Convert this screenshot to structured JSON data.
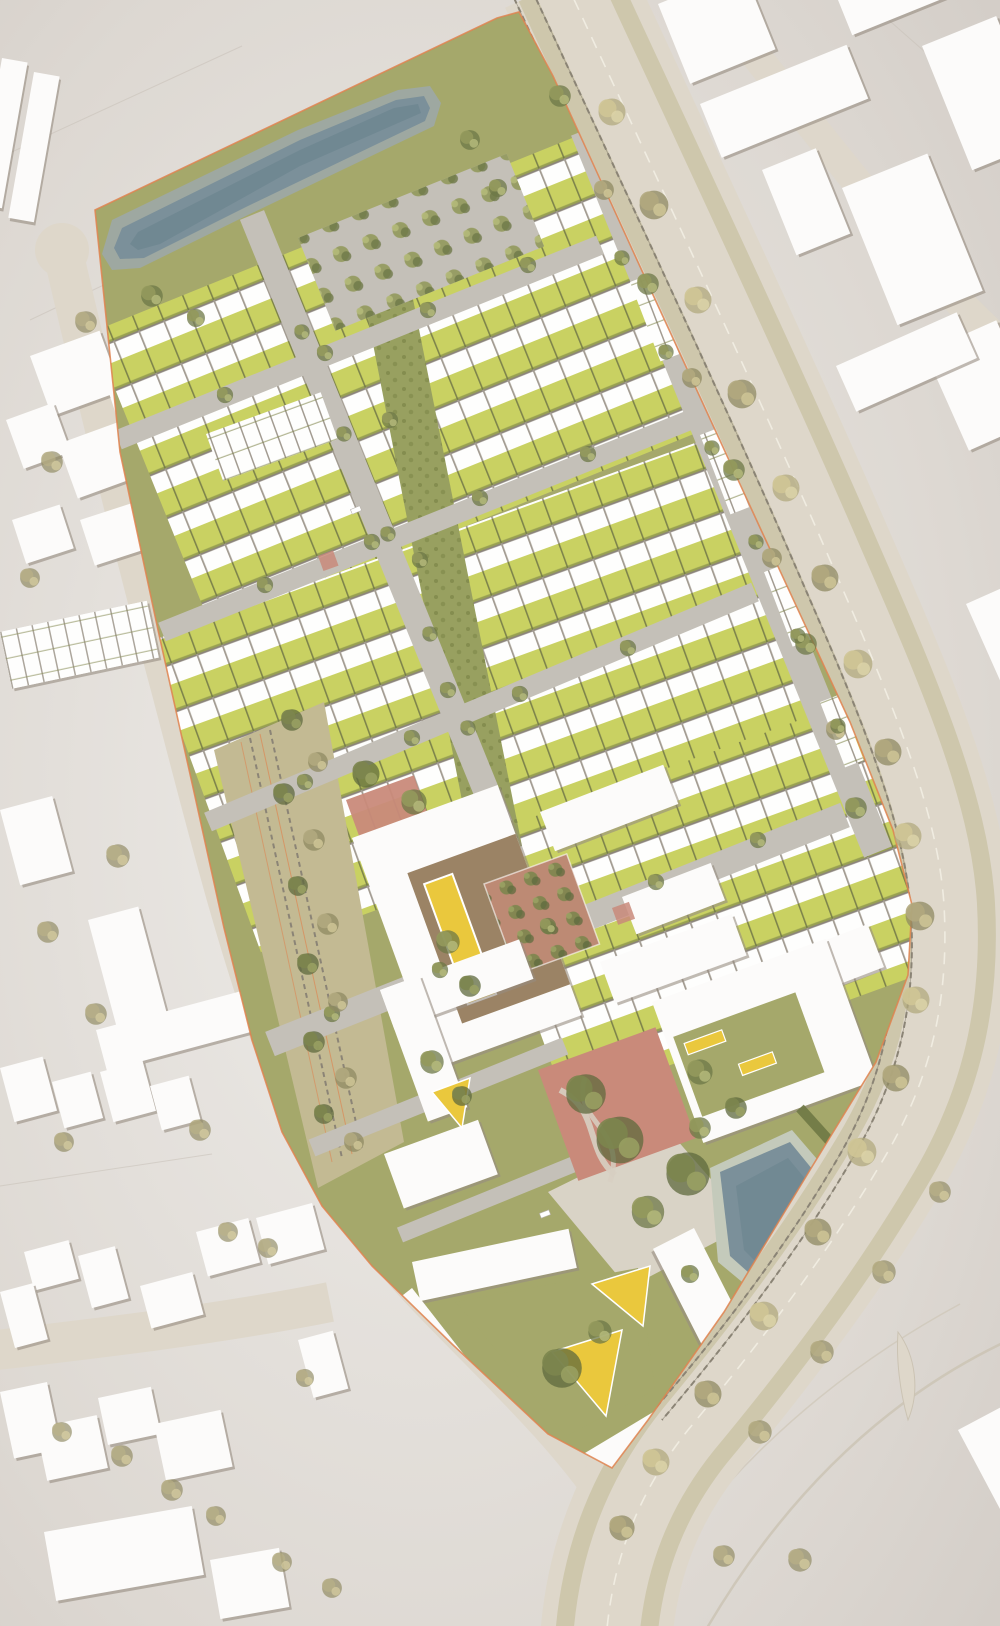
{
  "meta": {
    "title": "Aerial masterplan site plan rendering",
    "type": "architectural masterplan, top view, no text labels"
  },
  "palette": {
    "bg-center": "#eeece9",
    "bg-edge": "#d2ccc6",
    "paper-line": "#c7c0b6",
    "road": "#ded7ca",
    "road-edge": "#cbc3b3",
    "lane": "#f2eee3",
    "street": "#c4c0b8",
    "plaza": "#d9d3c6",
    "path": "#d7cfc2",
    "lawn": "#a5a86b",
    "lawn-dark": "#8f945a",
    "garden": "#c9d162",
    "garden-sep": "#7e844b",
    "hedge": "#6f7845",
    "meadow": "#98a060",
    "meadow-dot": "#848d4f",
    "verge": "#bdb78d",
    "gravel": "#c3ba93",
    "rail": "#8b8476",
    "roof": "#fefefd",
    "roof-sep": "#a39c92",
    "roof-eave": "#8c857b",
    "bldg": "#fcfbfa",
    "bldg-shadow": "#968c8099",
    "water": "#7b909a",
    "water-dark": "#67818c",
    "pond-rim": "#9ea8a1",
    "pond-rim2": "#c4cabb",
    "boundary": "#df824f",
    "court-brown": "#9b8365",
    "play-yellow": "#eac83d",
    "play-red": "#c98a7a",
    "orchard": "#bd8a74",
    "tree-olive-1": "#6e7847",
    "tree-olive-2": "#93995c",
    "tree-olive-3": "#b4b97a",
    "tree-autumn-1": "#8f8a62",
    "tree-autumn-2": "#b1a97e",
    "tree-autumn-3": "#cfc596",
    "tree-dark-1": "#5f6a3d",
    "tree-dark-2": "#7c854e",
    "tree-dark-3": "#9aa163",
    "car": "#ffffff"
  },
  "features": {
    "site": "Elongated residential masterplan site",
    "north_pond": "Linear retention pond on northern green",
    "south_pond": "Retention pond at south-east corner",
    "terraces": "Terraced housing rows with yellow-green gardens",
    "spine": "Central green meadow spine",
    "linear_park": "Tree-lined linear park with former rail tracks",
    "school": "Courtyard building with play court",
    "orchard": "Orchard garden square",
    "plaza": "Red neighbourhood play plaza with winding paths",
    "tree_square": "Paved square with tree grid",
    "avenue": "Boulevard with tram tracks and tree rows",
    "context": "Surrounding urban context buildings",
    "boundary": "Orange site boundary line"
  }
}
